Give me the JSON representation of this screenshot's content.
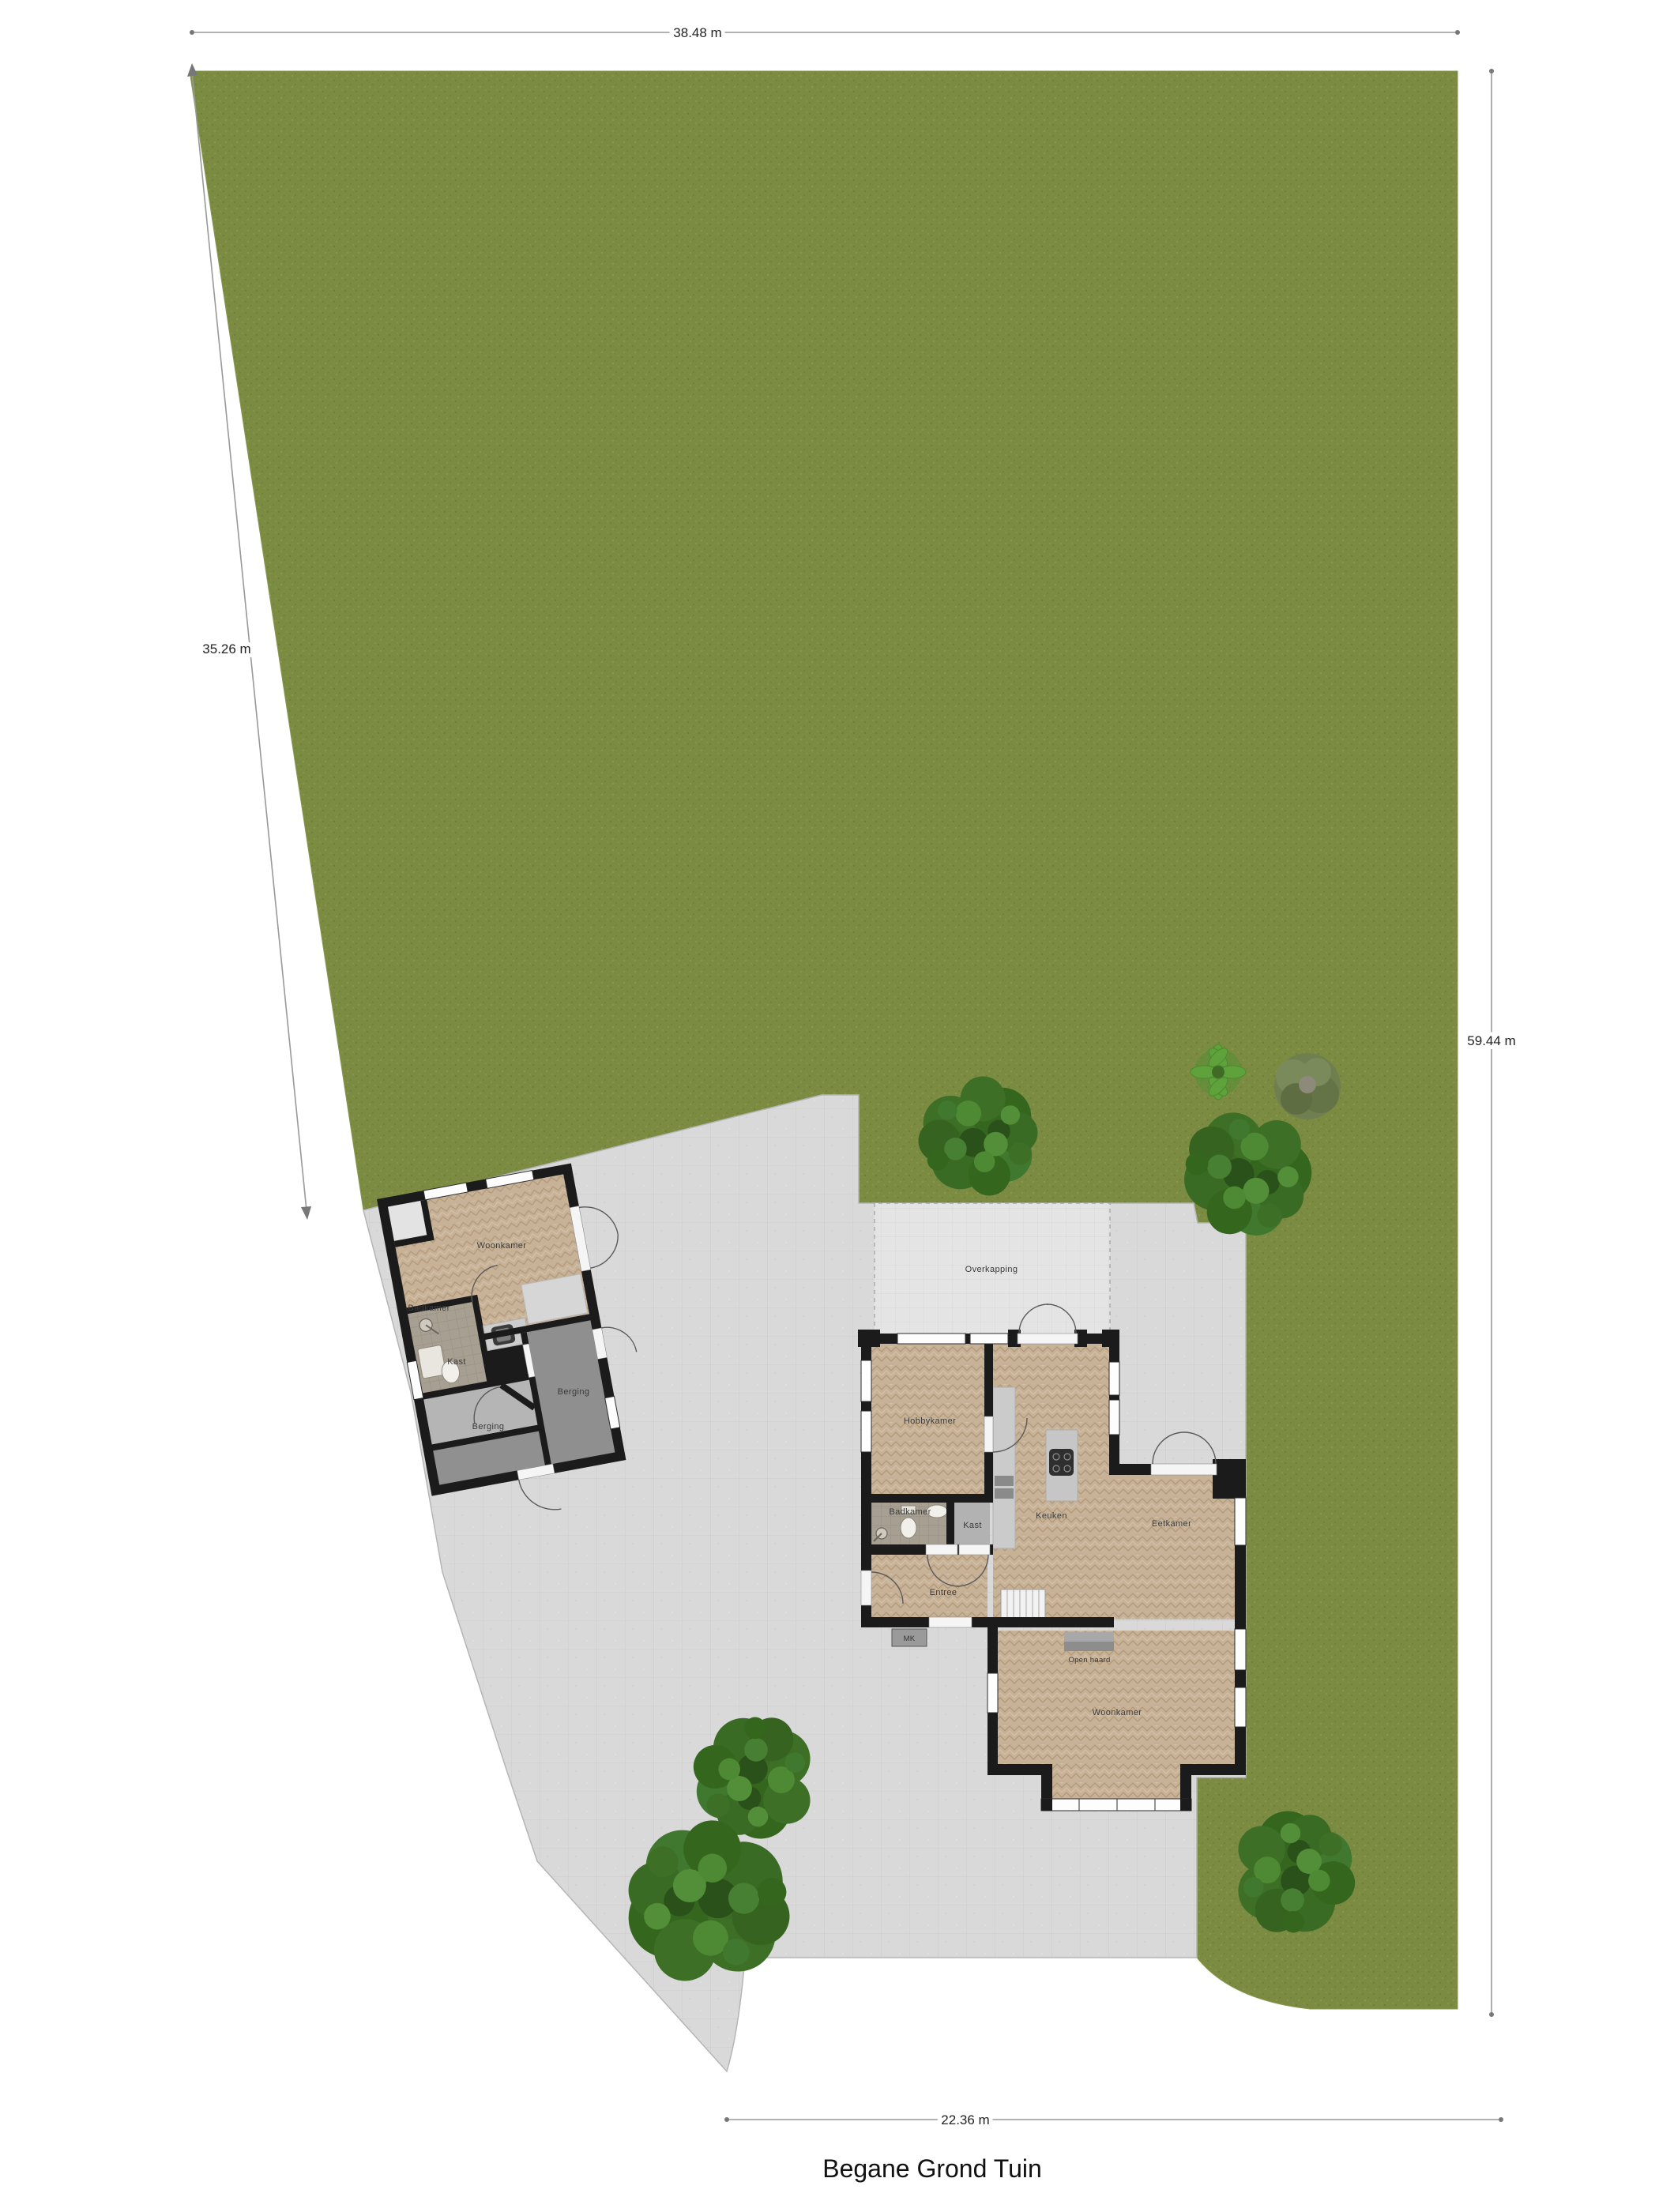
{
  "title": "Begane Grond Tuin",
  "dimensions": {
    "top": "38.48 m",
    "left": "35.26 m",
    "right": "59.44 m",
    "bottom": "22.36 m"
  },
  "shed": {
    "rooms": {
      "woonkamer": "Woonkamer",
      "badkamer": "Badkamer",
      "kast": "Kast",
      "berging_left": "Berging",
      "berging_right": "Berging"
    }
  },
  "house": {
    "rooms": {
      "overkapping": "Overkapping",
      "hobbykamer": "Hobbykamer",
      "badkamer": "Badkamer",
      "kast": "Kast",
      "keuken": "Keuken",
      "eetkamer": "Eetkamer",
      "entree": "Entree",
      "meterkast": "MK",
      "open_haard": "Open haard",
      "woonkamer": "Woonkamer"
    }
  },
  "colors": {
    "grass": "#7b8c42",
    "paving": "#d9d9d9",
    "paving_light": "#e4e4e4",
    "wall": "#1b1b1b",
    "wood_floor": "#c7b298",
    "gray_room": "#909090",
    "tree_dark": "#2f5a1f",
    "tree_mid": "#3c6f28",
    "tree_light": "#4a8132"
  }
}
